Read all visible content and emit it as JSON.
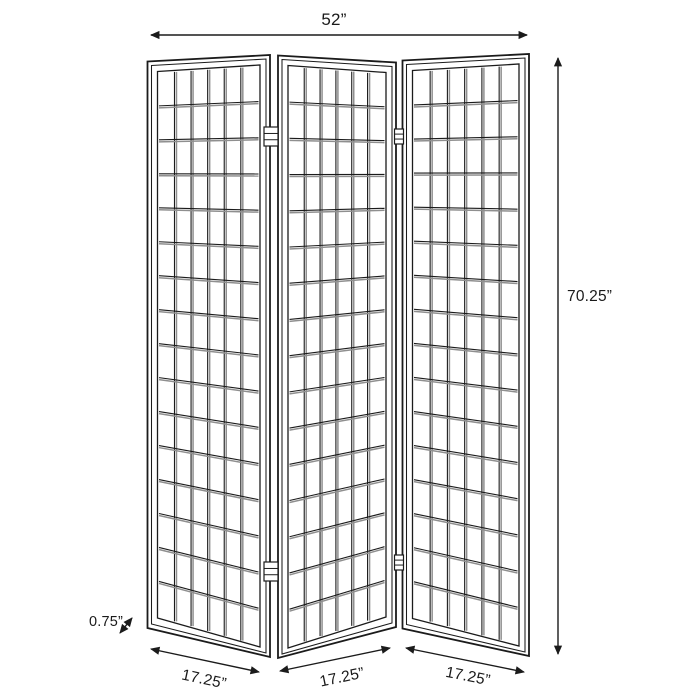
{
  "dimensions": {
    "overall_width": "52”",
    "overall_height": "70.25”",
    "frame_depth": "0.75”",
    "panel_widths": [
      "17.25”",
      "17.25”",
      "17.25”"
    ]
  },
  "figure": {
    "type": "three-panel-folding-screen",
    "panel_count": 3,
    "lattice_columns": 6,
    "lattice_rows": 16,
    "line_color": "#1b1b1b",
    "shade_color": "#8f8f8f",
    "background_color": "#ffffff"
  }
}
